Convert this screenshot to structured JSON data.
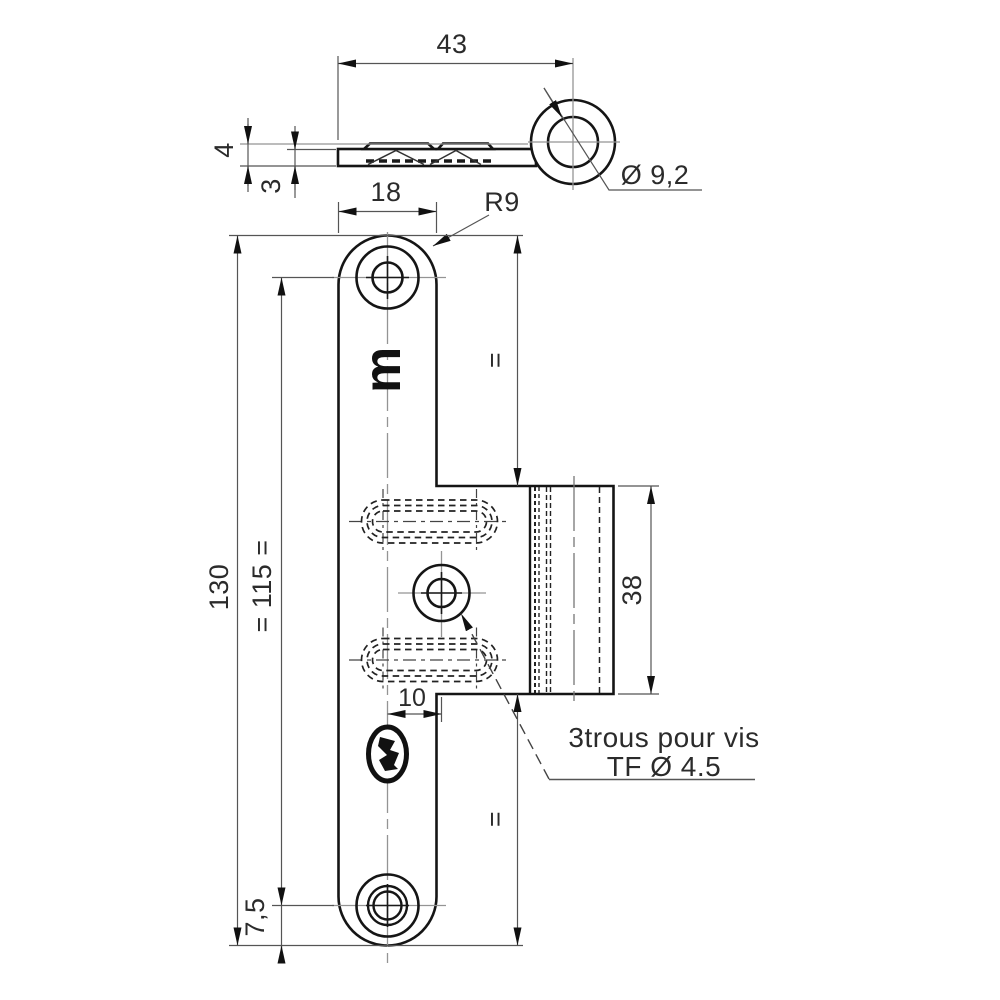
{
  "drawing": {
    "side_view": {
      "dims": {
        "width": "43",
        "total_thickness": "4",
        "plate_thickness": "3",
        "eye_diameter": "Ø 9,2"
      }
    },
    "front_view": {
      "dims": {
        "top_width": "18",
        "corner_radius": "R9",
        "total_length": "130",
        "hole_spacing": "= 115 =",
        "bottom_margin": "7,5",
        "equal_top": "=",
        "equal_bottom": "=",
        "box_height": "38",
        "center_offset": "10"
      },
      "note": {
        "line1": "3trous pour vis",
        "line2": "TF Ø 4.5"
      },
      "stamp_letter": "m"
    },
    "colors": {
      "object_line": "#151515",
      "hidden_line": "#222222",
      "dimension_line": "#555555",
      "centerline": "#949494",
      "text": "#2b2b2b",
      "background": "#ffffff"
    }
  }
}
